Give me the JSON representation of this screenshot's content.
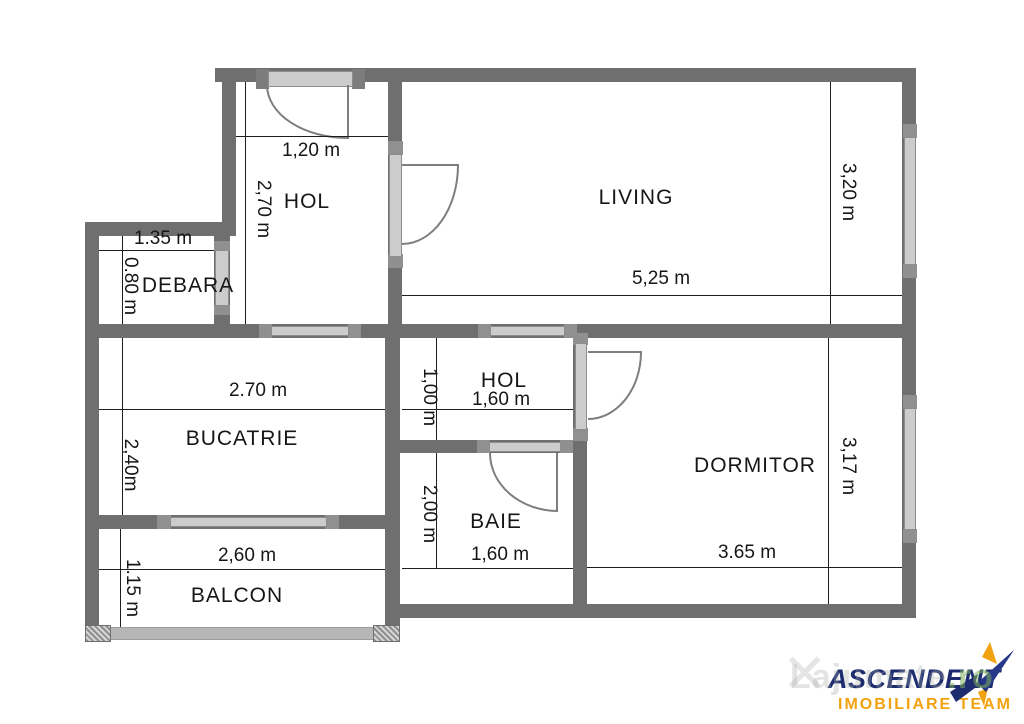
{
  "rooms": {
    "hol1": {
      "label": "HOL",
      "width": "1,20 m",
      "height": "2,70 m"
    },
    "living": {
      "label": "LIVING",
      "width": "5,25 m",
      "height": "3,20 m"
    },
    "debara": {
      "label": "DEBARA",
      "width": "1.35 m",
      "height": "0.80 m"
    },
    "bucatrie": {
      "label": "BUCATRIE",
      "width": "2.70 m",
      "height": "2,40m"
    },
    "hol2": {
      "label": "HOL",
      "width": "1,60 m",
      "height": "1,00 m"
    },
    "baie": {
      "label": "BAIE",
      "width": "1,60 m",
      "height": "2,00 m"
    },
    "dormitor": {
      "label": "DORMITOR",
      "width": "3.65 m",
      "height": "3,17 m"
    },
    "balcon": {
      "label": "BALCON",
      "width": "2,60 m",
      "height": "1.15 m"
    }
  },
  "branding": {
    "name": "ASCENDENT",
    "tagline": "IMOBILIARE TEAM",
    "watermark": "Lajumate",
    "watermark_suffix": ".ro"
  },
  "icons": {
    "watermark_x": "✕",
    "logo_star": "star-arrow-icon"
  },
  "colors": {
    "wall": "#6f6f6f",
    "window_fill": "#cccccc",
    "cap": "#909090",
    "railing": "#b7b7b7",
    "dimension_line": "#1e1e1e",
    "text": "#161616",
    "logo_navy": "#1d2b6f",
    "logo_orange": "#f2a20f"
  }
}
